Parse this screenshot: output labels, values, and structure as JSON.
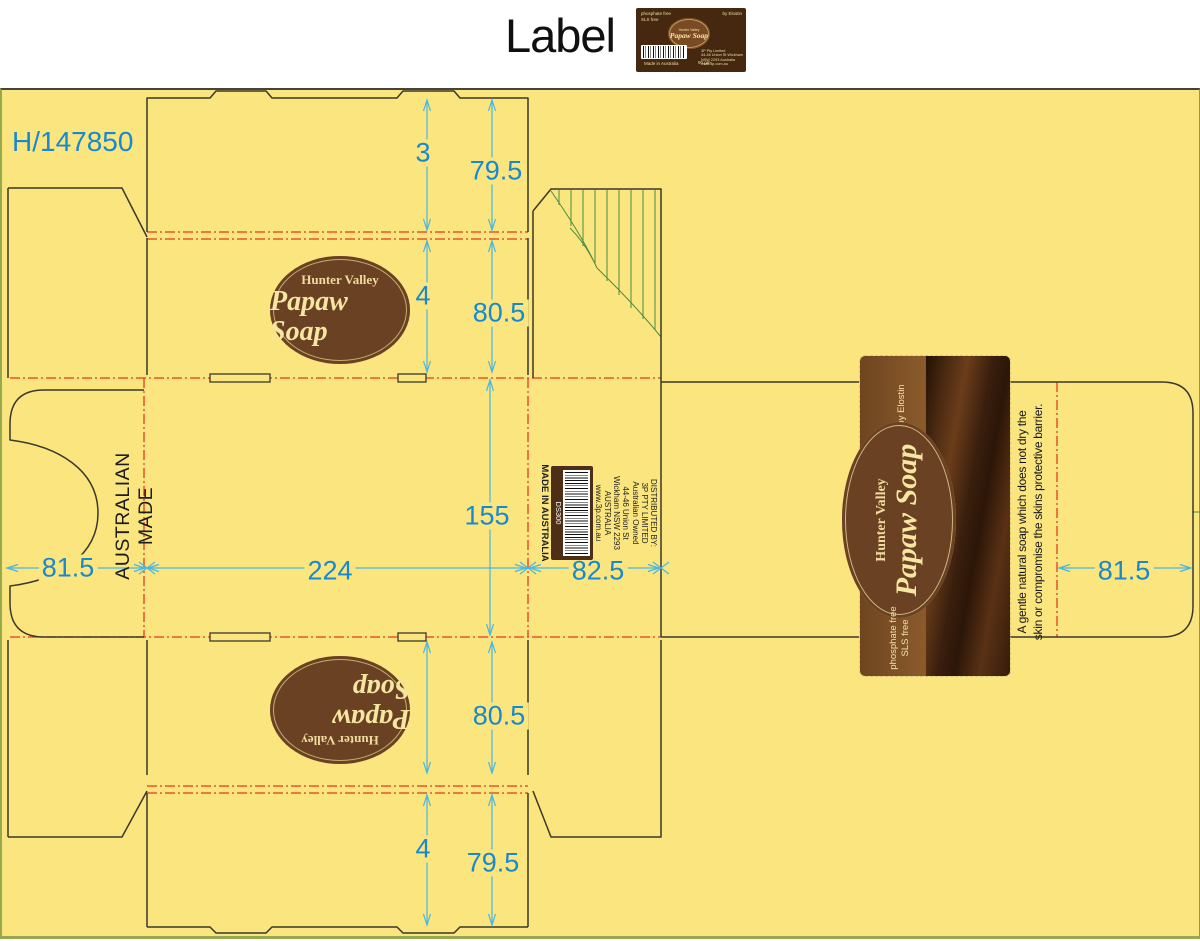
{
  "header": {
    "title": "Label"
  },
  "mini_label": {
    "phosphate_free": "phosphate free",
    "sls_free": "SLS free",
    "byline": "by Elostin",
    "brand_top": "Hunter Valley",
    "brand_name": "Papaw Soap",
    "made_in": "Made in Australia",
    "weight": "90 gm",
    "address_lines": [
      "3P Pty Limited",
      "44-46 Union St Wickham",
      "NSW 2293   Australia",
      "www.3p.com.au"
    ]
  },
  "drawing": {
    "reference": "H/147850",
    "side_text": "AUSTRALIAN MADE",
    "dims": {
      "tab_height": "3",
      "top_flap_depth": "79.5",
      "crease_gap_top": "4",
      "upper_panel_depth": "80.5",
      "body_depth": "155",
      "front_panel_width": "224",
      "side_panel_width": "82.5",
      "left_tuck_width": "81.5",
      "right_tuck_width": "81.5",
      "lower_panel_depth": "80.5",
      "crease_gap_bottom": "4",
      "bottom_flap_depth": "79.5"
    }
  },
  "logo_oval": {
    "line1": "Hunter Valley",
    "line2": "Papaw Soap"
  },
  "barcode_panel": {
    "lines": [
      "DISTRIBUTED BY:",
      "3P PTY LIMITED",
      "Australian Owned",
      "44-46 Union St",
      "Wickham NSW 2293",
      "AUSTRALIA",
      "www.3p.com.au"
    ],
    "code": "DS300",
    "made_in": "MADE IN AUSTRALIA"
  },
  "big_label": {
    "byline": "by Elostin",
    "brand_top": "Hunter Valley",
    "brand_name": "Papaw Soap",
    "phosphate_free": "phosphate free",
    "sls_free": "SLS free",
    "tagline_line1": "A gentle natural soap which does not dry the",
    "tagline_line2": "skin or compromise the skins protective barrier."
  },
  "colors": {
    "board_yellow": "#FAE57E",
    "dim_text_blue": "#1989CE",
    "dim_line_cyan": "#49B6E4",
    "crease_red": "#E6391C",
    "cut_line": "#3A382C",
    "hatch_green": "#4B8B44",
    "label_brown_dark": "#45280F",
    "label_band_brown": "#7D5226",
    "oval_brown": "#6B4123",
    "cream": "#F2E2A4"
  }
}
